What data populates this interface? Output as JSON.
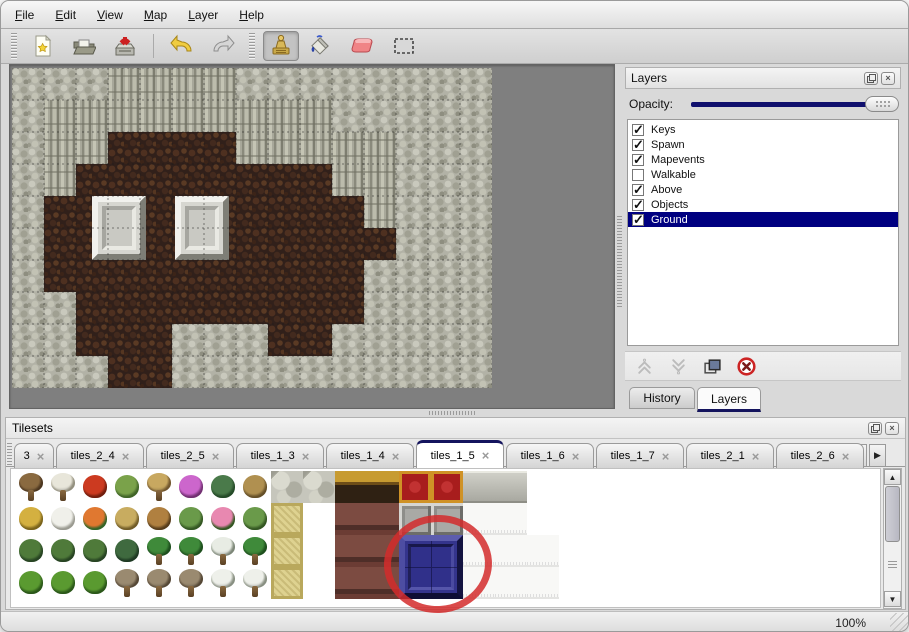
{
  "menu": {
    "items": [
      "File",
      "Edit",
      "View",
      "Map",
      "Layer",
      "Help"
    ]
  },
  "toolbar": {
    "tools": [
      "new-file",
      "open-file",
      "save-file",
      "undo",
      "redo",
      "stamp-tool",
      "fill-tool",
      "eraser-tool",
      "select-tool"
    ],
    "active_tool": "stamp-tool"
  },
  "map": {
    "tile_size": 32,
    "grid": [
      "RRRCCCCRRRRRRRR",
      "RCCCCCCCCCRRRRR",
      "RCCFFFFCCCCCRRR",
      "RCFFFFFFFFCCRRR",
      "RFFFFFFFFFFCRRR",
      "RFFFFFFFFFFFRRR",
      "RFFFFFFFFFFRRRR",
      "RRFFFFFFFFFRRRR",
      "RRFFFRRRFFRRRRR",
      "RRRFFRRRRRRRRRR"
    ],
    "pedestals": [
      {
        "x": 80,
        "y": 128,
        "w": 54,
        "h": 64
      },
      {
        "x": 163,
        "y": 128,
        "w": 54,
        "h": 64
      }
    ],
    "pedestal_colors": {
      "light": "#f1f1ed",
      "dark": "#7e7e76",
      "mid": "#d6d6d0",
      "in_dark": "#a6a6a0",
      "in_light": "#e9e9e3",
      "inner": "#c9c9c3"
    }
  },
  "layers_panel": {
    "title": "Layers",
    "opacity_label": "Opacity:",
    "layers": [
      {
        "name": "Keys",
        "checked": true,
        "selected": false
      },
      {
        "name": "Spawn",
        "checked": true,
        "selected": false
      },
      {
        "name": "Mapevents",
        "checked": true,
        "selected": false
      },
      {
        "name": "Walkable",
        "checked": false,
        "selected": false
      },
      {
        "name": "Above",
        "checked": true,
        "selected": false
      },
      {
        "name": "Objects",
        "checked": true,
        "selected": false
      },
      {
        "name": "Ground",
        "checked": true,
        "selected": true
      }
    ],
    "tabs": [
      {
        "label": "History",
        "active": false,
        "x": 4,
        "w": 66
      },
      {
        "label": "Layers",
        "active": true,
        "x": 72,
        "w": 64
      }
    ]
  },
  "tilesets_panel": {
    "title": "Tilesets",
    "tabs": [
      {
        "label": "3",
        "active": false,
        "w": 40
      },
      {
        "label": "tiles_2_4",
        "active": false,
        "w": 88
      },
      {
        "label": "tiles_2_5",
        "active": false,
        "w": 88
      },
      {
        "label": "tiles_1_3",
        "active": false,
        "w": 88
      },
      {
        "label": "tiles_1_4",
        "active": false,
        "w": 88
      },
      {
        "label": "tiles_1_5",
        "active": true,
        "w": 88
      },
      {
        "label": "tiles_1_6",
        "active": false,
        "w": 88
      },
      {
        "label": "tiles_1_7",
        "active": false,
        "w": 88
      },
      {
        "label": "tiles_2_1",
        "active": false,
        "w": 88
      },
      {
        "label": "tiles_2_6",
        "active": false,
        "w": 88
      }
    ],
    "active_tab": "tiles_1_5",
    "palette": {
      "trunk": {
        "kind": "tree",
        "c1": "#8a6a40",
        "c2": "#5c4226"
      },
      "branch": {
        "kind": "tree",
        "c1": "#e8e6da",
        "c2": "#b2ae9a"
      },
      "flower_red": {
        "kind": "blob",
        "c1": "#cc3a20",
        "c2": "#8a2410"
      },
      "stump": {
        "kind": "blob",
        "c1": "#7aa24a",
        "c2": "#4e7a30"
      },
      "trunk_tan": {
        "kind": "tree",
        "c1": "#c8a860",
        "c2": "#8a6a38"
      },
      "flower_purple": {
        "kind": "blob",
        "c1": "#cc66cc",
        "c2": "#8a3a8a"
      },
      "fern": {
        "kind": "blob",
        "c1": "#4a7a4a",
        "c2": "#2c5a30"
      },
      "twig": {
        "kind": "blob",
        "c1": "#b09050",
        "c2": "#7a6030"
      },
      "hay": {
        "kind": "blob",
        "c1": "#d4b040",
        "c2": "#947820"
      },
      "hay_snow": {
        "kind": "blob",
        "c1": "#f0f0ea",
        "c2": "#bcbcb0"
      },
      "flower_orange": {
        "kind": "blob",
        "c1": "#e07830",
        "c2": "#3f7a30"
      },
      "grass_dry": {
        "kind": "blob",
        "c1": "#c8ac60",
        "c2": "#8a7030"
      },
      "leaves": {
        "kind": "blob",
        "c1": "#b08040",
        "c2": "#6a4a20"
      },
      "lily": {
        "kind": "blob",
        "c1": "#6a9a4a",
        "c2": "#3f6a2a"
      },
      "flower_pink": {
        "kind": "blob",
        "c1": "#e888b0",
        "c2": "#3f6a2a"
      },
      "sprig": {
        "kind": "blob",
        "c1": "#4f7a3a",
        "c2": "#2f522a"
      },
      "bush_dark": {
        "kind": "blob",
        "c1": "#3f6a3f",
        "c2": "#24452a"
      },
      "palm": {
        "kind": "tree",
        "c1": "#3f8a3a",
        "c2": "#246024"
      },
      "palm_snow": {
        "kind": "tree",
        "c1": "#e8ece4",
        "c2": "#98a492"
      },
      "bush": {
        "kind": "blob",
        "c1": "#5a9a30",
        "c2": "#346a1f"
      },
      "dead_tree": {
        "kind": "tree",
        "c1": "#9a8a70",
        "c2": "#685842"
      },
      "pine_snow": {
        "kind": "tree",
        "c1": "#eef0ea",
        "c2": "#a6ae9e"
      },
      "stone": {
        "kind": "stone"
      },
      "wood": {
        "kind": "wood"
      },
      "carpet": {
        "kind": "carpet"
      },
      "slab": {
        "kind": "slab"
      },
      "mat": {
        "kind": "mat"
      },
      "chair": {
        "kind": "chair"
      },
      "block3d": {
        "kind": "block3d"
      },
      "white_tile": {
        "kind": "white_tile"
      }
    },
    "rows": [
      [
        "trunk",
        "branch",
        "flower_red",
        "stump",
        "trunk_tan",
        "flower_purple",
        "fern",
        "twig",
        "stone",
        "stone",
        "wood",
        "wood",
        "carpet",
        "carpet",
        "slab",
        "slab",
        "",
        ""
      ],
      [
        "hay",
        "hay_snow",
        "flower_orange",
        "grass_dry",
        "leaves",
        "lily",
        "flower_pink",
        "lily",
        "mat",
        "",
        "chair",
        "chair",
        "block3d",
        "block3d",
        "white_tile",
        "white_tile",
        "",
        ""
      ],
      [
        "sprig",
        "sprig",
        "sprig",
        "bush_dark",
        "palm",
        "palm",
        "palm_snow",
        "palm",
        "mat",
        "",
        "chair",
        "chair",
        "",
        "",
        "white_tile",
        "white_tile",
        "white_tile",
        ""
      ],
      [
        "bush",
        "bush",
        "bush",
        "dead_tree",
        "dead_tree",
        "dead_tree",
        "pine_snow",
        "pine_snow",
        "mat",
        "",
        "chair",
        "chair",
        "",
        "",
        "white_tile",
        "white_tile",
        "white_tile",
        ""
      ]
    ],
    "selection": {
      "col": 12,
      "row": 2,
      "cols": 2,
      "rows": 2
    }
  },
  "status": {
    "zoom_level": "100%"
  },
  "icons": {
    "close": "×",
    "check": "✓",
    "up": "▲",
    "down": "▼",
    "left": "◀",
    "right": "▶"
  },
  "colors": {
    "accent": "#14145e",
    "selection": "#000080",
    "annotation": "#d32b2b",
    "opacity_track": "#10106e"
  }
}
